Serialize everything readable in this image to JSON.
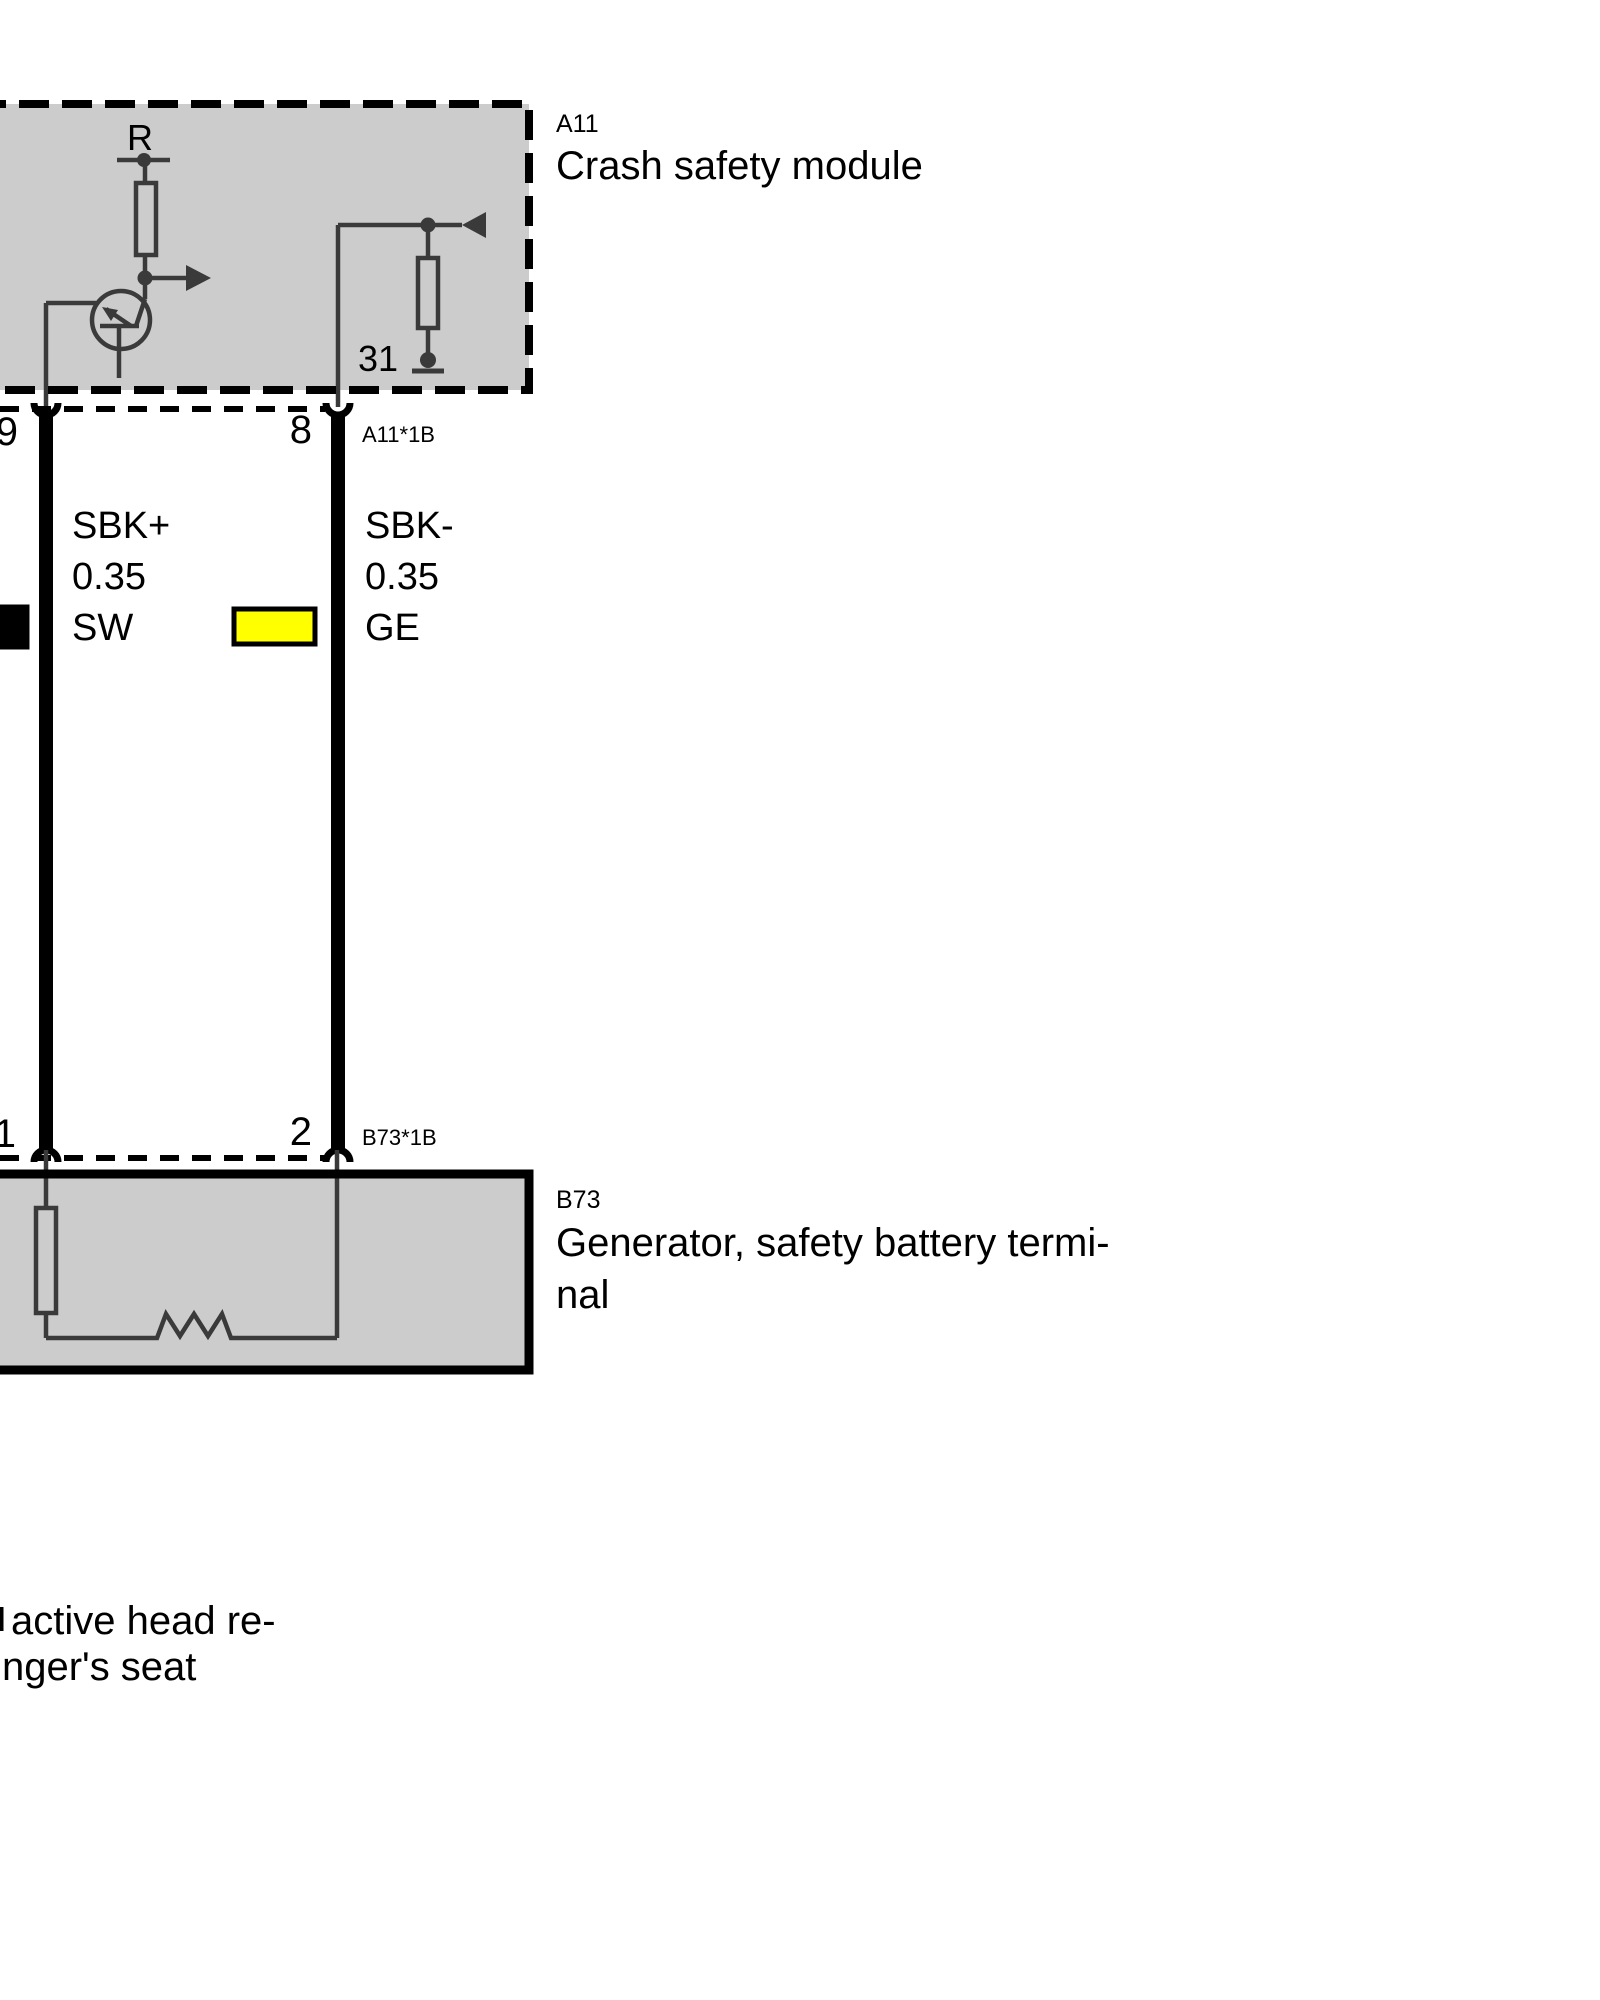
{
  "modules": {
    "a11": {
      "code": "A11",
      "name": "Crash safety module",
      "internal": {
        "resistor_label": "R",
        "ground_terminal": "31"
      },
      "connector": {
        "code": "A11*1B",
        "pin_left": "9",
        "pin_right": "8"
      }
    },
    "b73": {
      "code": "B73",
      "name_line1": "Generator, safety battery termi-",
      "name_line2": "nal",
      "connector": {
        "code": "B73*1B",
        "pin_left": "1",
        "pin_right": "2"
      }
    }
  },
  "wires": {
    "left": {
      "signal": "SBK+",
      "cross_section": "0.35",
      "color_code": "SW",
      "color_hex": "#000000"
    },
    "right": {
      "signal": "SBK-",
      "cross_section": "0.35",
      "color_code": "GE",
      "color_hex": "#ffff00"
    }
  },
  "footnote": {
    "line1": "active head re-",
    "line2": "nger's seat"
  },
  "palette": {
    "module_fill": "#cccccc",
    "symbol_stroke": "#3a3a3a",
    "wire_stroke": "#000000",
    "swatch_black": "#000000",
    "swatch_yellow": "#ffff00"
  }
}
